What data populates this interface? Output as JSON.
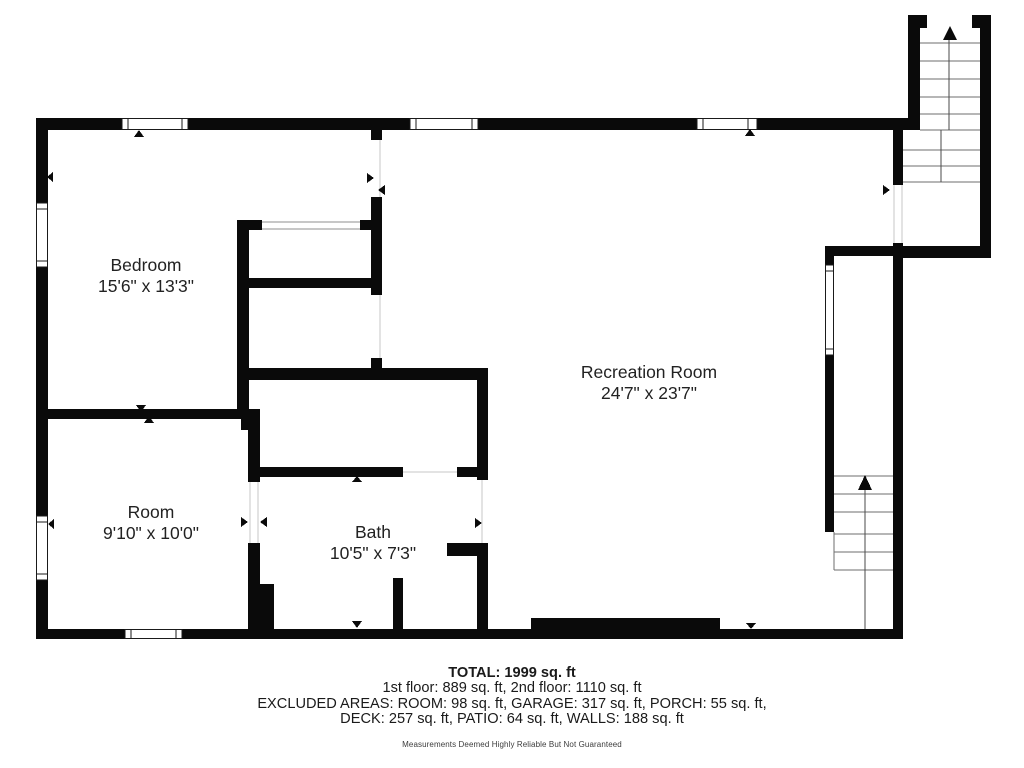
{
  "floorplan": {
    "rooms": [
      {
        "id": "bedroom",
        "name": "Bedroom",
        "dims": "15'6\" x 13'3\""
      },
      {
        "id": "room",
        "name": "Room",
        "dims": "9'10\" x 10'0\""
      },
      {
        "id": "bath",
        "name": "Bath",
        "dims": "10'5\" x 7'3\""
      },
      {
        "id": "recreation",
        "name": "Recreation Room",
        "dims": "24'7\" x 23'7\""
      }
    ]
  },
  "footer": {
    "total": "TOTAL: 1999 sq. ft",
    "floors": "1st floor: 889 sq. ft, 2nd floor: 1110 sq. ft",
    "excluded_line1": "EXCLUDED AREAS: ROOM: 98 sq. ft, GARAGE: 317 sq. ft, PORCH: 55 sq. ft,",
    "excluded_line2": "DECK: 257 sq. ft, PATIO: 64 sq. ft, WALLS: 188 sq. ft",
    "disclaimer": "Measurements Deemed Highly Reliable But Not Guaranteed"
  },
  "colors": {
    "wall": "#0a0a0a",
    "text": "#222222",
    "tread": "#6e6e6e",
    "threshold": "#c7c7c7",
    "background": "#ffffff"
  }
}
